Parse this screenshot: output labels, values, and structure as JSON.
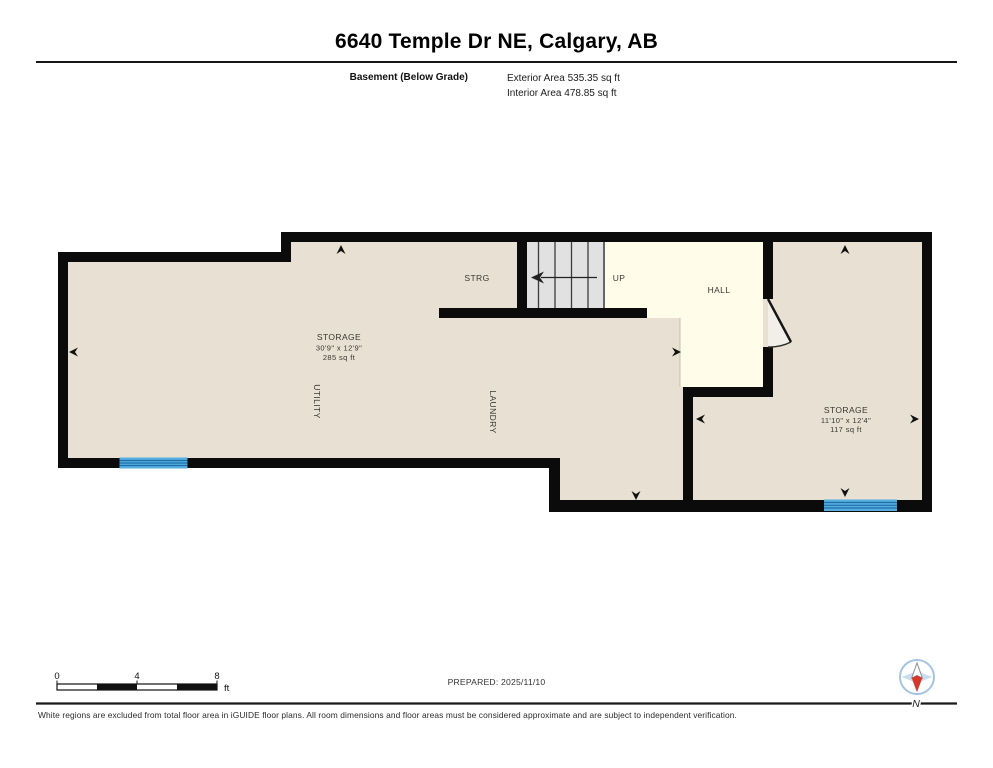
{
  "header": {
    "title": "6640 Temple Dr NE, Calgary, AB",
    "floor_label": "Basement (Below Grade)",
    "exterior_area": "Exterior Area 535.35 sq ft",
    "interior_area": "Interior Area 478.85 sq ft"
  },
  "rooms": {
    "strg": "STRG",
    "up": "UP",
    "hall": "HALL",
    "utility": "UTILITY",
    "laundry": "LAUNDRY",
    "storage_main": {
      "name": "STORAGE",
      "dims": "30'9\" x 12'9\"",
      "area": "285 sq ft"
    },
    "storage_right": {
      "name": "STORAGE",
      "dims": "11'10\" x 12'4\"",
      "area": "117 sq ft"
    }
  },
  "scale_bar": {
    "t0": "0",
    "t4": "4",
    "t8": "8",
    "unit": "ft"
  },
  "prepared": "PREPARED: 2025/11/10",
  "compass_label": "N",
  "footer": "White regions are excluded from total floor area in iGUIDE floor plans. All room dimensions and floor areas must be considered approximate and are subject to independent verification.",
  "colors": {
    "wall": "#0b0b0b",
    "floor": "#e8e0d2",
    "hall_floor": "#fffde9",
    "stairs": "#e1e1e1",
    "window_blue": "#55aee0",
    "window_stripe": "#1d6ea8",
    "compass_blue": "#c9ddf0",
    "compass_red": "#d6372b"
  }
}
